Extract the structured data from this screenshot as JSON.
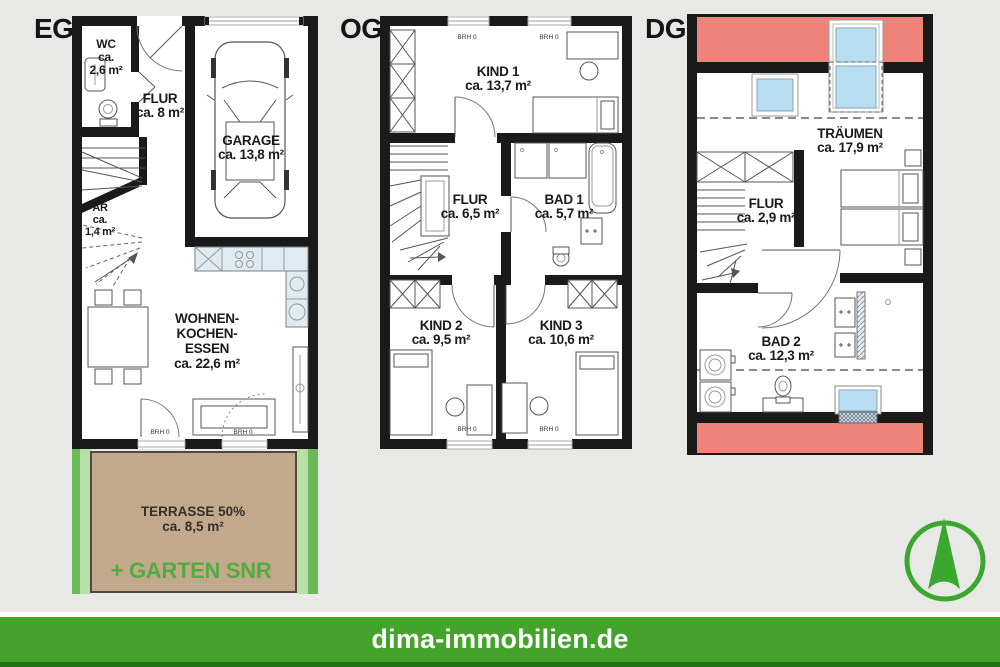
{
  "page": {
    "background": "#e8e8e7"
  },
  "colors": {
    "wall": "#1a1a1a",
    "roof_red": "#ee8379",
    "skylight_blue": "#b9ddf1",
    "kitchen_blue": "#dfeaf1",
    "terrace_tan": "#c3a98c",
    "garden_green_dark": "#69b958",
    "garden_green_light": "#b7dfa8",
    "brand_green": "#43a32a",
    "garten_text_green": "#55ab43"
  },
  "floors": {
    "eg": {
      "label": "EG",
      "wc": {
        "name": "WC",
        "area_l1": "ca.",
        "area_l2": "2,6 m²"
      },
      "flur": {
        "name": "FLUR",
        "area": "ca. 8 m²"
      },
      "garage": {
        "name": "GARAGE",
        "area": "ca. 13,8 m²"
      },
      "ar": {
        "name": "AR",
        "area_l1": "ca.",
        "area_l2": "1,4 m²"
      },
      "wohnen": {
        "name_l1": "WOHNEN-",
        "name_l2": "KOCHEN-",
        "name_l3": "ESSEN",
        "area": "ca. 22,6 m²"
      },
      "terrasse": {
        "name": "TERRASSE 50%",
        "area": "ca. 8,5 m²"
      },
      "garten": {
        "name": "+ GARTEN SNR"
      }
    },
    "og": {
      "label": "OG",
      "kind1": {
        "name": "KIND 1",
        "area": "ca. 13,7 m²"
      },
      "flur": {
        "name": "FLUR",
        "area": "ca. 6,5 m²"
      },
      "bad1": {
        "name": "BAD 1",
        "area": "ca. 5,7 m²"
      },
      "kind2": {
        "name": "KIND 2",
        "area": "ca. 9,5 m²"
      },
      "kind3": {
        "name": "KIND 3",
        "area": "ca. 10,6 m²"
      }
    },
    "dg": {
      "label": "DG",
      "traeumen": {
        "name": "TRÄUMEN",
        "area": "ca. 17,9 m²"
      },
      "flur": {
        "name": "FLUR",
        "area": "ca. 2,9 m²"
      },
      "bad2": {
        "name": "BAD 2",
        "area": "ca. 12,3 m²"
      }
    }
  },
  "window_label": "BRH 0",
  "footer": {
    "text": "dima-immobilien.de"
  }
}
